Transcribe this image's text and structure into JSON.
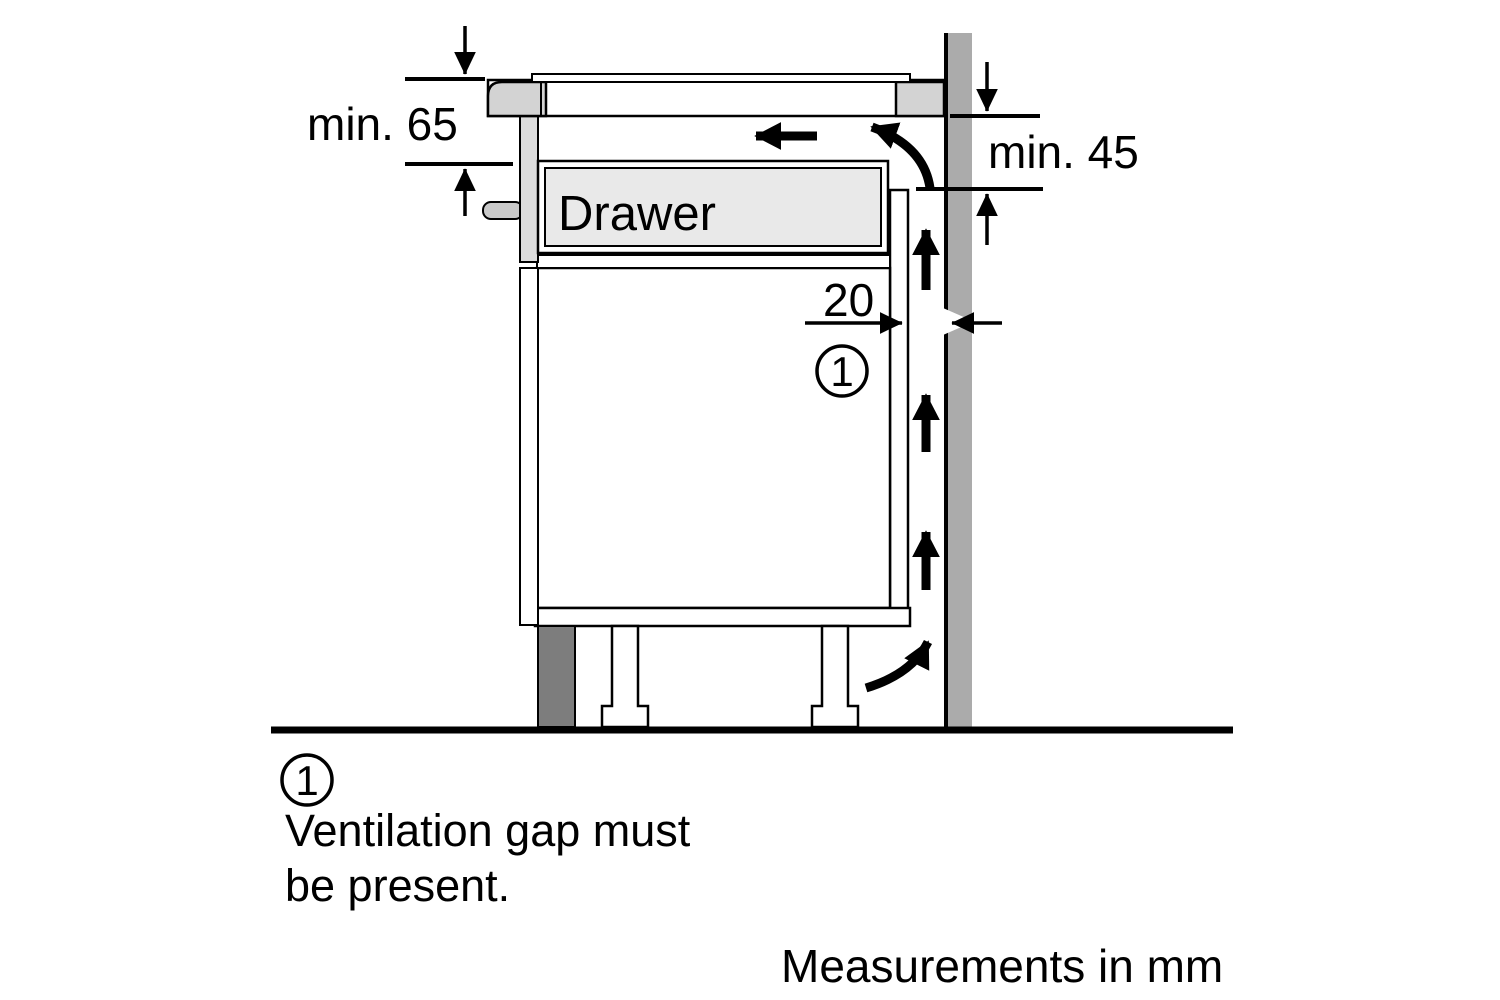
{
  "figure": {
    "dims": {
      "min_top_left": "min. 65",
      "min_right": "min. 45",
      "gap": "20"
    },
    "drawer_label": "Drawer",
    "callout_number": "1",
    "note": {
      "marker": "1",
      "line1": "Ventilation gap must",
      "line2": "be present."
    },
    "units_note": "Measurements in mm",
    "colors": {
      "wall": "#ababab",
      "worktop_block": "#d3d3d3",
      "hob_trim": "#dcdcdc",
      "knob": "#c9c9c9",
      "drawer_fill": "#e9e9e9",
      "plinth": "#7d7d7d",
      "ink": "#000000",
      "background": "#ffffff"
    }
  }
}
